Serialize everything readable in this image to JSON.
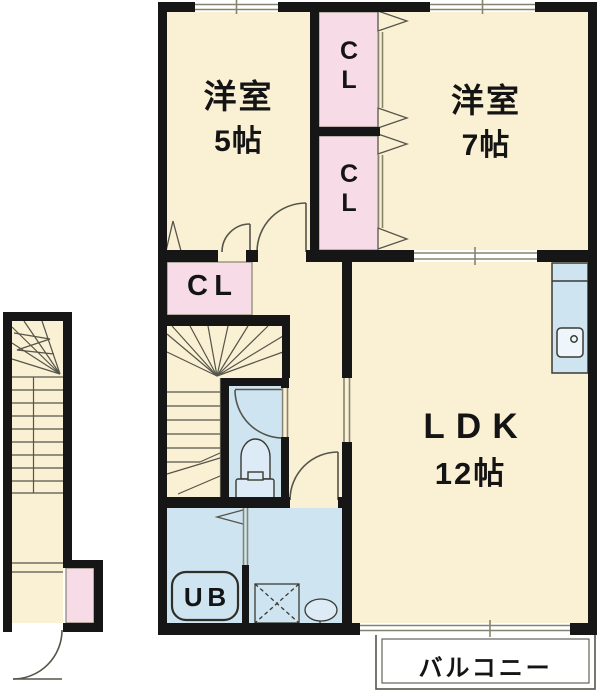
{
  "floorplan": {
    "rooms": {
      "western5": {
        "name": "洋室",
        "size": "5帖"
      },
      "western7": {
        "name": "洋室",
        "size": "7帖"
      },
      "ldk": {
        "name": "LDK",
        "size": "12帖"
      },
      "closet_upper": {
        "label": "C\nL"
      },
      "closet_lower": {
        "label": "C\nL"
      },
      "closet_hall": {
        "label": "CL"
      },
      "unit_bath": {
        "label": "UB"
      },
      "balcony": {
        "label": "バルコニー"
      }
    },
    "colors": {
      "floor": "#FAF0D4",
      "closet": "#F7DBE7",
      "wet_area": "#CFE4F1",
      "wall": "#161616",
      "window_line": "#85856F",
      "detail_line": "#55554A"
    }
  }
}
